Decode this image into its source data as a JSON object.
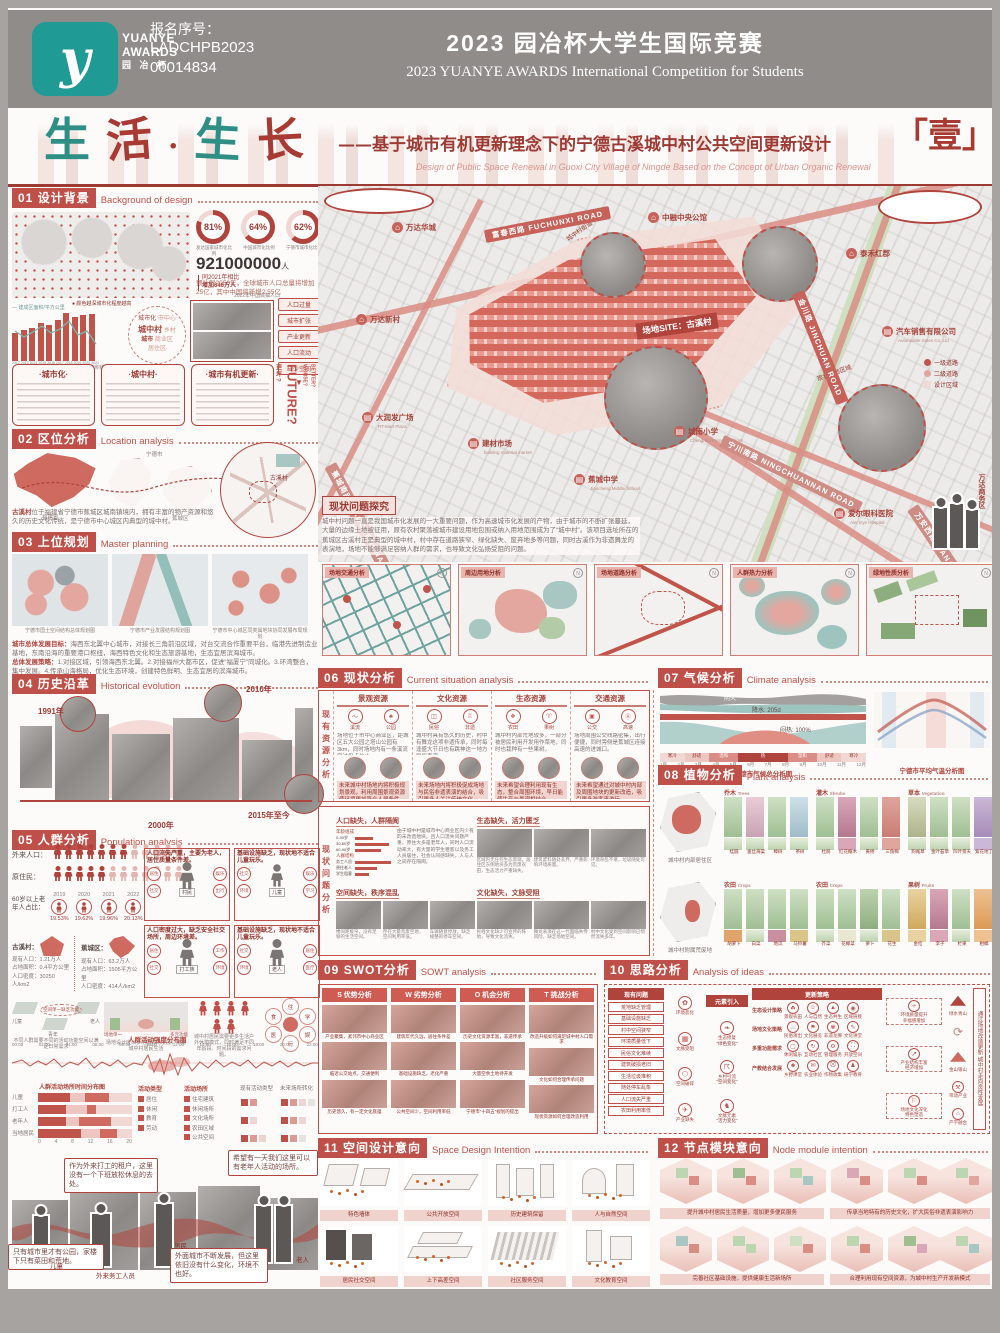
{
  "header": {
    "logo_glyph": "y",
    "logo_line1": "YUANYE",
    "logo_line2": "AWARDS",
    "logo_line3": "园 冶 杯",
    "serial_label": "报名序号：",
    "serial1": "LADCHPB2023",
    "serial2": "00014834",
    "title_cn": "2023 园冶杯大学生国际竞赛",
    "title_en": "2023 YUANYE AWARDS International Competition for  Students"
  },
  "masthead": {
    "c1": "生",
    "c2": "活",
    "dot": "·",
    "c3": "生",
    "c4": "长",
    "subtitle_cn": "——基于城市有机更新理念下的宁德古溪城中村公共空间更新设计",
    "subtitle_en": "Design of Public Space Renewal in Guoxi City Village of Ningde Based on the Concept of Urban Organic Renewal",
    "sheet_no": "「壹」"
  },
  "s01": {
    "num": "01",
    "cn": "设计背景",
    "en": "Background of design",
    "map_legend": "颜色越深城市化程度越高",
    "donuts": [
      {
        "pct": "81%",
        "label": "发达国家城市化比例"
      },
      {
        "pct": "64%",
        "label": "中国城市化比例"
      },
      {
        "pct": "62%",
        "label": "宁德市城市化比例"
      }
    ],
    "big": "921000000",
    "big_unit": "人",
    "big_sub": "2022年中国城镇人口",
    "delta1": "同2021年相比",
    "delta2": "增加646万人",
    "forecast": "预计到2050年，全球城市人口总量将增加25亿，其中中国将新增2.55亿",
    "bar_legend": "建成区面积/平方公里",
    "bar_caption": "2011-2021年宁德市城市建成区面积统计图",
    "years": [
      "2012",
      "2013",
      "2014",
      "2015",
      "2016",
      "2017",
      "2018",
      "2019",
      "2020",
      "2021"
    ],
    "bar_values": [
      28,
      31,
      33,
      38,
      36,
      41,
      48,
      44,
      46,
      47
    ],
    "circle": {
      "c1": "城市化",
      "c2": "城中村",
      "c3": "城市",
      "c4": "乡村",
      "c5": "市中心",
      "c6": "商业区",
      "c7": "居住区"
    },
    "tags": [
      "人口过量",
      "城市扩张",
      "产业更新",
      "人口流动",
      "缺少空间"
    ],
    "boxes": [
      "·城市化·",
      "·城中村·",
      "·城市有机更新·"
    ],
    "future": {
      "q": "FUTURE?",
      "cn1": "更坏?",
      "cn2": "更好?",
      "w": "WORSE?",
      "b": "BETTER?"
    }
  },
  "s02": {
    "num": "02",
    "cn": "区位分析",
    "en": "Location analysis",
    "lab_fj": "福建省",
    "lab_nd": "宁德市",
    "lab_jc": "蕉城区",
    "lab_gx": "古溪村",
    "cap_hl": "古溪村",
    "caption": "位于福建省宁德市蕉城区城南镇境内，拥有丰富的物产资源和悠久的历史文化传统，是宁德市中心城区内典型的城中村。"
  },
  "s03": {
    "num": "03",
    "cn": "上位规划",
    "en": "Master planning",
    "caps": [
      "宁德市国土空间结构总体规划图",
      "宁德市产业发展结构规划图",
      "宁德市中心城区同类属地块协同发展布局规划"
    ],
    "goal_label": "城市总体发展目标：",
    "goal": "海西东北翼中心城市，对接长三角前沿区域，对台交流合作重要平台，临港先进制造业基地，东南沿海的重要港口枢纽，海西特色文化和生态旅游基地，生态宜居滨海城市。",
    "strat_label": "总体发展策略：",
    "strat": "1.对接区域，引领海西东北翼。2.对接福州大都市区，促进“福厦宁”同城化。3.环湾整合，集中发展。4.传承山海格局，优化生态环境，创建特色鲜明、生态宜居的滨海城市。"
  },
  "s04": {
    "num": "04",
    "cn": "历史沿革",
    "en": "Historical evolution",
    "y1": "1991年",
    "y2": "2000年",
    "y3": "2010年",
    "y4": "2015年至今"
  },
  "s05": {
    "num": "05",
    "cn": "人群分析",
    "en": "Population analysis",
    "row1": "外来人口：",
    "row2": "原住民：",
    "elderly_label": "60岁以上老年人占比：",
    "eyears": [
      "2019",
      "2020",
      "2021",
      "2022"
    ],
    "epcts": [
      "19.53%",
      "19.62%",
      "19.96%",
      "20.13%"
    ],
    "areas": [
      {
        "name": "古溪村：",
        "pop": "现有人口：1.21万人",
        "area": "占地面积：0.4平方公里",
        "den": "人口密度：30250人/km2"
      },
      {
        "name": "蕉城区：",
        "pop": "现有人口：63.2万人",
        "area": "占地面积：1505平方公里",
        "den": "人口密度：414人/km2"
      }
    ],
    "cards": [
      {
        "chip1": "现状",
        "chip2": "需求",
        "text": "人口流失严重，主要为老人，居住质量条件差。",
        "person": "村民",
        "icons": [
          "居住",
          "娱乐",
          "社交",
          "出行"
        ]
      },
      {
        "chip1": "现状",
        "chip2": "需求",
        "text": "基础设施缺乏，现状地不适合儿童玩乐。",
        "person": "儿童",
        "icons": [
          "社交",
          "娱乐",
          "环境",
          "学习"
        ]
      },
      {
        "chip1": "现状",
        "chip2": "需求",
        "text": "人口密度过大，缺乏安全社交场所，周边环境差。",
        "person": "打工族",
        "icons": [
          "居住",
          "工作",
          "社交",
          "环境"
        ]
      },
      {
        "chip1": "现状",
        "chip2": "需求",
        "text": "基础设施缺乏，现状地不适合儿童玩乐。",
        "person": "老人",
        "icons": [
          "社交",
          "居住",
          "环境",
          "医疗"
        ]
      }
    ],
    "mini1": {
      "a": "儿童",
      "b": "老人",
      "c": "青年",
      "note": "空间单一缺乏功能",
      "cap": "不同人群需要不同的活动功能空间以满足日常需求"
    },
    "mini2": {
      "l1": "场地单一",
      "l2": "多元功能",
      "cap": "场地设计应以多功能方向发展，丰富城中村居民生活"
    },
    "mini3": {
      "cap": "城中村居民需要更多生活户外休憩模式，同时满足不同年龄段、时间段的需求问题。"
    },
    "petals": [
      "住",
      "学",
      "娱",
      "行",
      "医",
      "食"
    ],
    "intensity_title": "人群活动强度分布图",
    "times": [
      "00:00",
      "02:00",
      "04:00",
      "06:00",
      "08:00",
      "10:00",
      "12:00",
      "14:00",
      "16:00",
      "18:00",
      "20:00",
      "22:00"
    ],
    "place_title": "人群活动场所时间分布图",
    "place_rows": [
      "儿童",
      "打工人",
      "老年人",
      "当地居民"
    ],
    "axis": [
      "0",
      "4",
      "8",
      "12",
      "16",
      "20"
    ],
    "legend1_title": "活动类型",
    "legend1": [
      "居住",
      "休闲",
      "教育",
      "劳动"
    ],
    "legend2_title": "活动场所",
    "legend2": [
      "住宅建筑",
      "休闲场所",
      "文化场所",
      "农田区域",
      "公共空间"
    ],
    "grid1_title": "现有活动类型",
    "grid2_title": "未来场所转化"
  },
  "comic": {
    "b1": "作为外来打工的租户，这里没有一个下班放松休息的去处。",
    "b2": "希望有一天我们这里可以有老年人活动的场所。",
    "b3": "只有城市里才有公园，家楼下只有菜田和荒地。",
    "b4": "外面城市不断发展，但这里依旧没有什么变化，环境不也好。",
    "l1": "儿童",
    "l2": "外来务工人员",
    "l3": "居民",
    "l4": "老人"
  },
  "sitemap": {
    "wanda": "万达华城",
    "fuchun": "富春西路 FUCHUNXI ROAD",
    "zhongrong": "中融中央公馆",
    "taihe": "泰禾红郡",
    "jinchuan": "金川路 JINCHUAN ROAD",
    "auto": "汽车销售有限公司",
    "auto_en": "Automobile Sales Co.,Ltd",
    "site": "场地SITE：古溪村",
    "wandaxc": "万达新村",
    "rtmart": "大润发广场",
    "rtmart_en": "RT-Mart Plaza",
    "material": "建材市场",
    "material_en": "building material market",
    "jiaochengnan": "蕉城南路 JIAOCHENGNAN ROAD",
    "middle": "蕉城中学",
    "middle_en": "Jiaocheng Middle School",
    "primary": "城南小学",
    "primary_en": "Chengnan Primary School",
    "ningchuan": "宁川南路 NINGCHUANNAN ROAD",
    "aier": "爱尔眼科医院",
    "aier_en": "Aier Eye Hospital",
    "wananxi": "万安西路 WANANXI ROAD",
    "wandabiz": "万达商务区",
    "inset1": "城中村街道",
    "inset2": "现状场地区域",
    "legend": [
      "一级道路",
      "二级道路",
      "设计区域"
    ],
    "prob_title": "现状问题探究",
    "prob_text": "城中村问题一直是我国城市化发展的一大重要问题，作为高速城市化发展的产物，由于城市的不断扩张蔓延，大量的边缘土地被征用，原有农村聚落被城市建设用地包围或纳入用地范围成为了“城中村”。该项目选址所在的蕉城区古溪村正是典型的城中村，村中存在道路狭窄、绿化缺失、废弃地多等问题，同时古溪作为非遗舞龙的表演地，场地不能够满足容纳人群的需求，也导致文化弘扬受阻的问题。"
  },
  "analysis_maps": [
    "场地交通分析",
    "周边用地分析",
    "场地道路分析",
    "人群热力分析",
    "绿地性质分析"
  ],
  "s06": {
    "num": "06",
    "cn": "现状分析",
    "en": "Current situation analysis",
    "vlab1": "现有资源分析",
    "vlab2": "现状问题分析",
    "resources": [
      {
        "title": "景观资源",
        "icons": [
          "溪流",
          "公园"
        ],
        "text": "场地位于市中心商业区，距城区五大公园之塔山公园有3km，同时场地内有一条溪流穿过但点位小。",
        "future": "未来城中村场地内将积极规划景观，利用周围景观资源使环境更加符合人居条件。"
      },
      {
        "title": "文化资源",
        "icons": [
          "民俗",
          "非遗"
        ],
        "text": "城中村具有悠久的历史，村中有舞龙这项非遗传承，同时每逢盛大节日也有跳神这一地方民俗表演。",
        "future": "未来场地内将积极促成场地与民俗非遗表演的结合，吸引更多人关注传统文化。"
      },
      {
        "title": "生态资源",
        "icons": [
          "农田",
          "果树"
        ],
        "text": "城中村内部荒地较多，一部分被居民利用开发用作菜地，同时也栽种有一些果树。",
        "future": "未来希望合理利用现有生态，整合周围环境，早日能使生产与景观相结合。"
      },
      {
        "title": "交通资源",
        "icons": [
          "公交",
          "高速"
        ],
        "text": "场地周围公交线路密集，出行便捷，同时旁侧是蕉城区连接高速的进城口。",
        "future": "未来希望通过对城中村内部及周围地块的更新改造，吸引更多游客来游玩。"
      }
    ],
    "p1": {
      "title": "人口缺失，人群隔阂",
      "g1": "年龄组成",
      "ages": [
        "0-30岁",
        "30-60岁",
        "60-90岁"
      ],
      "g2": "人群结构",
      "groups": [
        "务工人员",
        "原住老人",
        "学生租客"
      ],
      "text": "由于城中村是城市中心商业区内少有的未改造地块，且人口流失问题严重，原住大多是老年人，同时人口流动率大，有大量的学生租客以及务工人员居住，社会认同感缺失，人与人之间存在隔阂。"
    },
    "p2": {
      "title": "生态缺失，活力匮乏",
      "caps": [
        "区域内无任何生态景观，居住区东侧地块多为荒废农田，生态活力严重缺失。",
        "建筑废料随处丢弃，严重影响环境质量。",
        "环境杂乱不堪，垃圾随处可见。"
      ]
    },
    "p3": {
      "title": "空间缺失，秩序混乱",
      "caps": [
        "楼间距极窄，没有足够的生活空间。",
        "存在大量荒废空地，空间利用率低。",
        "车辆随意停放，缺乏规整的停车空间。"
      ]
    },
    "p4": {
      "title": "文化缺失，文脉受阻",
      "caps": [
        "民俗文化缺少可宣传的阵地，导致文化流失。",
        "舞龙表演在这一代面临失传风险，缺乏场地空间。",
        "村中文化受到空间影响已悄然流失多年。"
      ]
    }
  },
  "s07": {
    "num": "07",
    "cn": "气候分析",
    "en": "Climate analysis",
    "cap1": "宁德市气候总分析图",
    "cap2": "宁德市平均气温分析图",
    "ann1": "阴天",
    "ann2": "降水：205d",
    "ann3": "闷热：100%",
    "bands": [
      "寒冷",
      "舒适",
      "温和",
      "热",
      "温和",
      "舒适",
      "寒冷"
    ],
    "months": [
      "1月",
      "2月",
      "3月",
      "4月",
      "5月",
      "6月",
      "7月",
      "8月",
      "9月",
      "10月",
      "11月",
      "12月"
    ]
  },
  "s08": {
    "num": "08",
    "cn": "植物分析",
    "en": "Plant analysis",
    "zone1": "城中村内部居住区",
    "zone2": "城中村附属荒废地",
    "groups": [
      {
        "cat": "乔木",
        "en": "Trees",
        "items": [
          "桂圆",
          "垂丝海棠",
          "樟树",
          "茶树"
        ]
      },
      {
        "cat": "灌木",
        "en": "Shrubs",
        "items": [
          "杜鹃",
          "红花檵木",
          "黄杨",
          "三角梅"
        ]
      },
      {
        "cat": "草本",
        "en": "Vegetation",
        "items": [
          "狗尾草",
          "金叶苔草",
          "凹叶景天",
          "紫花地丁"
        ]
      },
      {
        "cat": "农田",
        "en": "Crops",
        "items": [
          "胡萝卜",
          "白菜",
          "地瓜",
          "马铃薯"
        ]
      },
      {
        "cat": "农田",
        "en": "Crops",
        "items": [
          "芥菜",
          "花椰菜",
          "萝卜",
          "花生"
        ]
      },
      {
        "cat": "果树",
        "en": "Fruits",
        "items": [
          "金桔",
          "李子",
          "杧果",
          "柑橘"
        ]
      }
    ]
  },
  "s09": {
    "num": "09",
    "cn": "SWOT分析",
    "en": "SOWT analysis",
    "cols": [
      {
        "chip": "S 优势分析",
        "caps": [
          "产业聚集，紧邻市中心商业区",
          "临近公交站点，交通便利",
          "历史悠久，有一定文化底蕴"
        ]
      },
      {
        "chip": "W 劣势分析",
        "caps": [
          "建筑年代久远，居住条件差",
          "基础设施缺乏，老化严重",
          "公共空间少，空间利用率低"
        ]
      },
      {
        "chip": "O 机会分析",
        "caps": [
          "历史文化资源丰富，非遗传承",
          "大量空余土地待开发",
          "宁德市“十四五”规划的提出"
        ]
      },
      {
        "chip": "T 挑战分析",
        "caps": [
          "改造升级如何满足城中村人口需求",
          "文化如何合理传承问题",
          "现状资源如何合理改造利用"
        ]
      }
    ]
  },
  "s10": {
    "num": "10",
    "cn": "思路分析",
    "en": "Analysis of ideas",
    "h1": "现有问题",
    "h2": "元素引入",
    "h3": "更新策略",
    "h4": "未来发展",
    "problems": [
      "荒地缺乏管理",
      "基础设施缺乏",
      "村中空间狭窄",
      "环境质量低下",
      "民俗文化难续",
      "建筑破损老旧",
      "生活垃圾堆积",
      "随处停车乱象",
      "人口流失严重",
      "农田利用率低"
    ],
    "mid": [
      "环境恶化",
      "文脉受阻",
      "空间破碎",
      "产业缺失"
    ],
    "elements": [
      {
        "name": "生态修复",
        "quote": "“绿色变化”"
      },
      {
        "name": "乡村引流",
        "quote": "“空间变化”"
      },
      {
        "name": "文脉元素",
        "quote": "“活力变化”"
      }
    ],
    "strategies": [
      {
        "name": "生态设计策略",
        "items": [
          "景观农田",
          "人与自然",
          "生态共生",
          "区域链接"
        ]
      },
      {
        "name": "场地文化策略",
        "items": [
          "民俗演出",
          "文化展览",
          "非遗龙狮",
          "文化讲堂"
        ]
      },
      {
        "name": "多重功能需求",
        "items": [
          "休闲娱乐",
          "互动社区",
          "管理服务",
          "开放空间"
        ]
      },
      {
        "name": "产教结合发展",
        "items": [
          "乡野课堂",
          "农业体验",
          "作物收集",
          "研学教育"
        ]
      }
    ],
    "futures": [
      {
        "t1": "环境质量提升",
        "t2": "幸福感增加"
      },
      {
        "t1": "产业结构丰富",
        "t2": "经济增加"
      },
      {
        "t1": "场地文化深化",
        "t2": "特色塑造"
      }
    ],
    "right": {
      "m1": "绿水青山",
      "m2": "金山银山",
      "i1": "带动产业",
      "i2": "产学融合",
      "tail": "通过场地改造更新 城中村走向良性发展"
    }
  },
  "s11": {
    "num": "11",
    "cn": "空间设计意向",
    "en": "Space Design Intention",
    "captions": [
      "特色墙体",
      "公共开放空间",
      "历史建筑保留",
      "人与自然空间",
      "居民社交空间",
      "上下高差空间",
      "社区服务空间",
      "文化教育空间"
    ]
  },
  "s12": {
    "num": "12",
    "cn": "节点模块意向",
    "en": "Node module intention",
    "captions": [
      "提升城中村居民生活质量，增加更多便民服务",
      "传承当地特有的历史文化，扩大民俗非遗表演影响力",
      "完善社区基础设施，提供健康生活新场所",
      "合理利用现有空间资源，为城中村生产开发新模式"
    ]
  }
}
